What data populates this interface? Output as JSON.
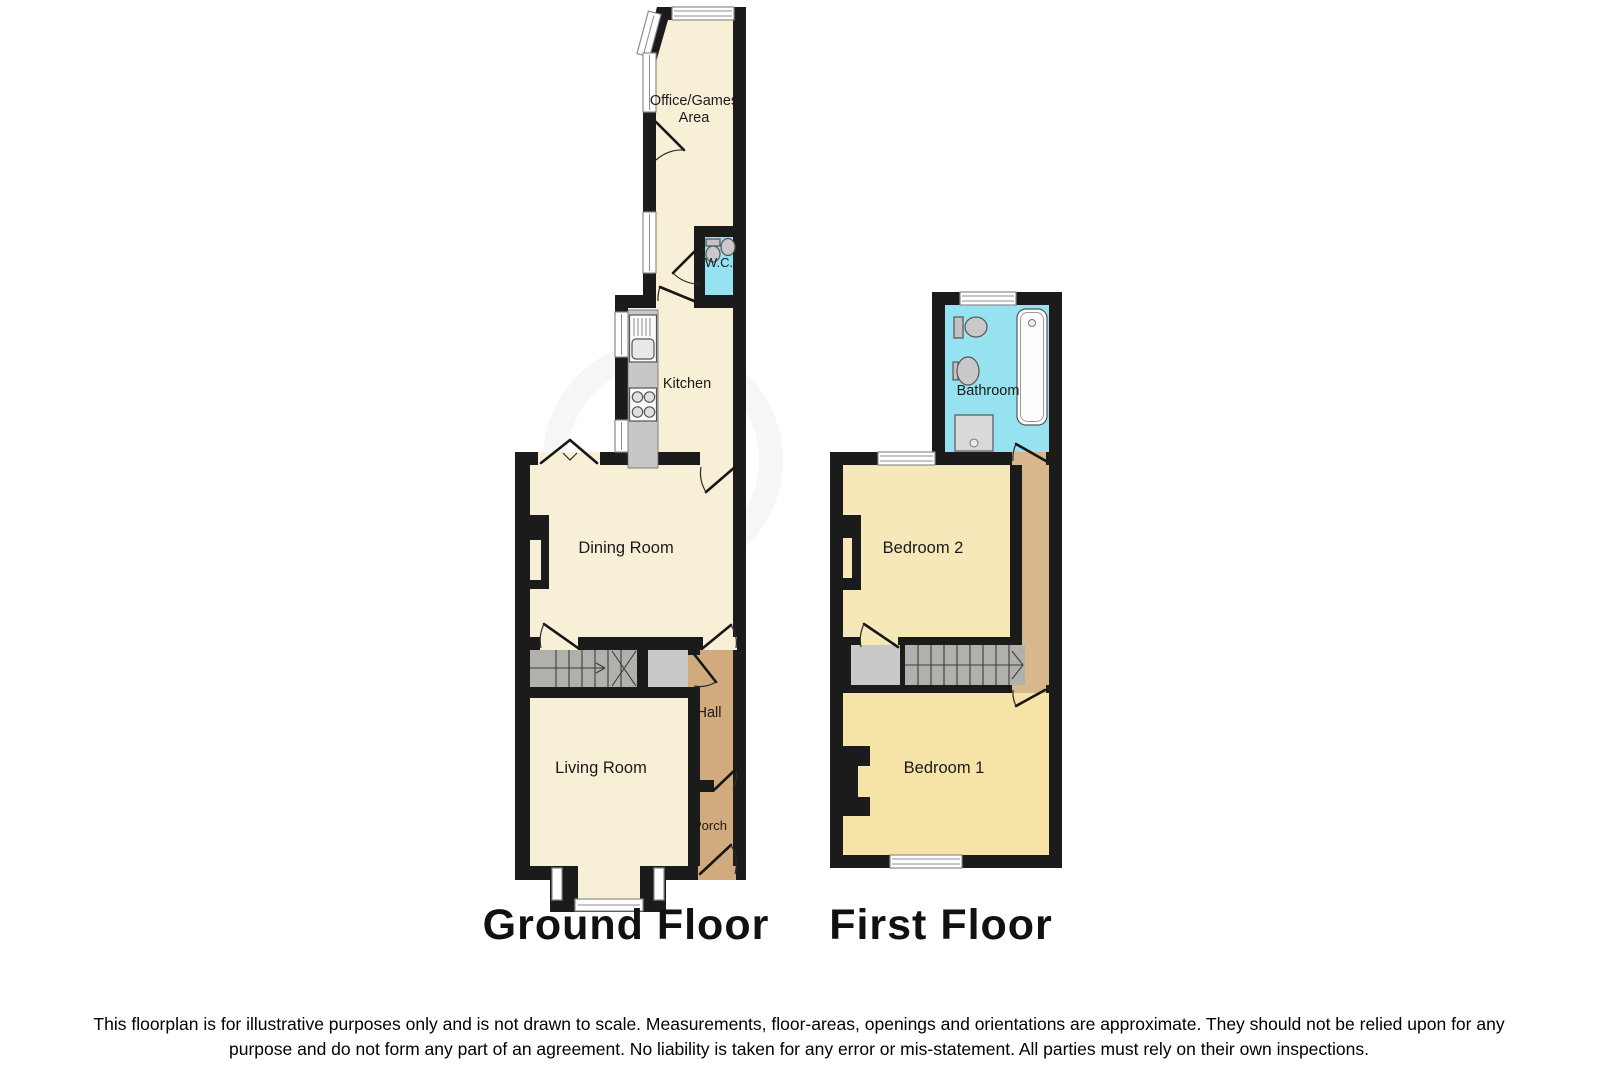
{
  "ground_floor": {
    "title": "Ground Floor",
    "rooms": {
      "office": {
        "line1": "Office/Games",
        "line2": "Area"
      },
      "wc": {
        "label": "W.C."
      },
      "kitchen": {
        "label": "Kitchen"
      },
      "dining": {
        "label": "Dining Room"
      },
      "hall": {
        "label": "Hall"
      },
      "living": {
        "label": "Living Room"
      },
      "porch": {
        "label": "Porch"
      }
    }
  },
  "first_floor": {
    "title": "First Floor",
    "rooms": {
      "bathroom": {
        "label": "Bathroom"
      },
      "bedroom2": {
        "label": "Bedroom 2"
      },
      "bedroom1": {
        "label": "Bedroom 1"
      }
    }
  },
  "disclaimer": {
    "line1": "This floorplan is for illustrative purposes only and is not drawn to scale. Measurements, floor-areas, openings and orientations are approximate. They should not be relied upon for any",
    "line2": "purpose and do not form any part of an agreement. No liability is taken for any error or mis-statement. All parties must rely on their own inspections."
  },
  "colors": {
    "wall": "#1b1b1b",
    "cream": "#f7f0d7",
    "yellow1": "#f5e3a7",
    "yellow2": "#f7e8b9",
    "cyan": "#97e2f1",
    "tan": "#d1ab7e",
    "tan_light": "#d8b78c",
    "stairs": "#b1b0ad",
    "cupboard": "#c9c9c9",
    "counter": "#c7c7c7"
  }
}
